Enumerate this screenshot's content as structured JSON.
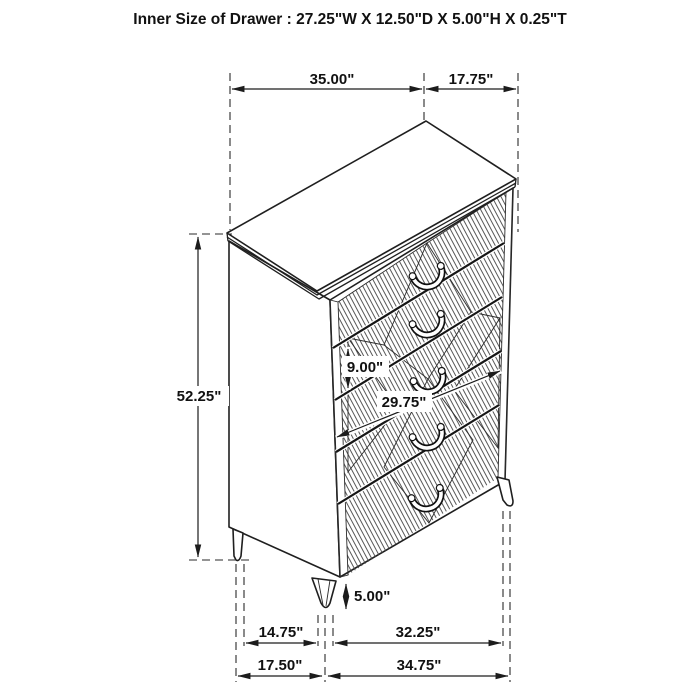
{
  "header": {
    "title": "Inner Size of Drawer : 27.25\"W X 12.50\"D X 5.00\"H X 0.25\"T"
  },
  "dimensions": {
    "top_width": "35.00\"",
    "top_depth": "17.75\"",
    "overall_height": "52.25\"",
    "drawer_front_height": "9.00\"",
    "drawer_front_width": "29.75\"",
    "leg_height": "5.00\"",
    "leg_span_depth_inner": "14.75\"",
    "leg_span_width_inner": "32.25\"",
    "leg_span_depth_outer": "17.50\"",
    "leg_span_width_outer": "34.75\""
  },
  "colors": {
    "line": "#1f1f1f",
    "background": "#ffffff"
  }
}
